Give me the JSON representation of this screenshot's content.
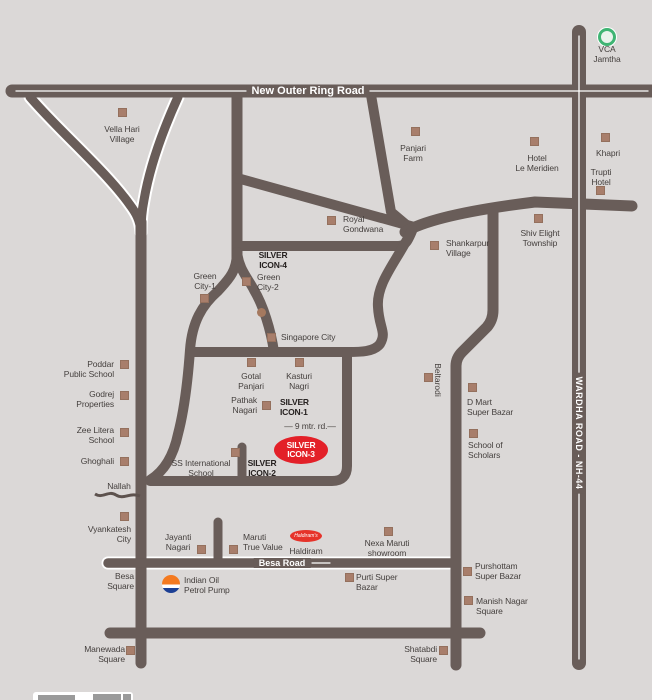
{
  "map": {
    "title_region": "site location map",
    "colors": {
      "background": "#dbd8d7",
      "road": "#695d59",
      "road_line_white": "#ffffff",
      "marker": "#a87e6b",
      "badge_red": "#e32028",
      "vca_green": "#3fb473",
      "haldiram_red": "#e6332a",
      "indianoil_orange": "#f47a20",
      "indianoil_blue": "#1c3f94",
      "label_text": "#443f3d"
    },
    "road_labels": [
      {
        "type": "roadlabel",
        "id": "new-outer-ring-road",
        "text": "New Outer Ring Road",
        "x": 308,
        "y": 91,
        "size": 11
      },
      {
        "type": "roadlabel",
        "id": "besa-road",
        "text": "Besa Road",
        "x": 282,
        "y": 563,
        "size": 9
      },
      {
        "type": "vroadlabel",
        "id": "wardha-road-nh-44",
        "text": "WARDHA ROAD - NH-44",
        "x": 579,
        "y": 433,
        "size": 9
      }
    ],
    "places": [
      {
        "type": "vca-icon",
        "id": "vca-jamtha-icon",
        "x": 607,
        "y": 37
      },
      {
        "id": "vca-jamtha",
        "lines": [
          "VCA",
          "Jamtha"
        ],
        "align": "center",
        "x": 607,
        "y": 44
      },
      {
        "id": "vella-hari-village",
        "lines": [
          "Vella Hari",
          "Village"
        ],
        "align": "center",
        "x": 122,
        "y": 124,
        "marker": {
          "x": 122,
          "y": 112
        }
      },
      {
        "id": "panjari-farm",
        "lines": [
          "Panjari",
          "Farm"
        ],
        "align": "center",
        "x": 413,
        "y": 143,
        "marker": {
          "x": 415,
          "y": 131
        }
      },
      {
        "id": "hotel-le-meridien",
        "lines": [
          "Hotel",
          "Le Meridien"
        ],
        "align": "center",
        "x": 537,
        "y": 153,
        "marker": {
          "x": 534,
          "y": 141
        }
      },
      {
        "id": "khapri",
        "lines": [
          "Khapri"
        ],
        "align": "center",
        "x": 608,
        "y": 148,
        "marker": {
          "x": 605,
          "y": 137
        }
      },
      {
        "id": "trupti-hotel",
        "lines": [
          "Trupti",
          "Hotel"
        ],
        "align": "center",
        "x": 601,
        "y": 167,
        "marker": {
          "x": 600,
          "y": 190
        }
      },
      {
        "id": "royal-gondwana",
        "lines": [
          "Royal",
          "Gondwana"
        ],
        "align": "left",
        "x": 343,
        "y": 214,
        "marker": {
          "x": 331,
          "y": 220
        }
      },
      {
        "id": "shankarpur-village",
        "lines": [
          "Shankarpur",
          "Village"
        ],
        "align": "left",
        "x": 446,
        "y": 238,
        "marker": {
          "x": 434,
          "y": 245
        }
      },
      {
        "id": "shiv-elight-township",
        "lines": [
          "Shiv Elight",
          "Township"
        ],
        "align": "center",
        "x": 540,
        "y": 228,
        "marker": {
          "x": 538,
          "y": 218
        }
      },
      {
        "id": "silver-icon-4",
        "lines": [
          "SILVER",
          "ICON-4"
        ],
        "align": "center",
        "x": 273,
        "y": 250,
        "bold": true
      },
      {
        "id": "green-city-1",
        "lines": [
          "Green",
          "City-1"
        ],
        "align": "center",
        "x": 205,
        "y": 271,
        "marker": {
          "x": 204,
          "y": 298
        }
      },
      {
        "id": "green-city-2",
        "lines": [
          "Green",
          "City-2"
        ],
        "align": "left",
        "x": 257,
        "y": 272,
        "marker": {
          "x": 246,
          "y": 281
        }
      },
      {
        "type": "dot",
        "id": "green-city-dot",
        "x": 261,
        "y": 312
      },
      {
        "id": "singapore-city",
        "lines": [
          "Singapore City"
        ],
        "align": "left",
        "x": 281,
        "y": 332,
        "marker": {
          "x": 271,
          "y": 337
        }
      },
      {
        "id": "poddar-public-school",
        "lines": [
          "Poddar",
          "Public School"
        ],
        "align": "right",
        "x": 114,
        "y": 359,
        "marker": {
          "x": 124,
          "y": 364
        }
      },
      {
        "id": "godrej-properties",
        "lines": [
          "Godrej",
          "Properties"
        ],
        "align": "right",
        "x": 114,
        "y": 389,
        "marker": {
          "x": 124,
          "y": 395
        }
      },
      {
        "id": "zee-litera-school",
        "lines": [
          "Zee Litera",
          "School"
        ],
        "align": "right",
        "x": 114,
        "y": 425,
        "marker": {
          "x": 124,
          "y": 432
        }
      },
      {
        "id": "ghoghali",
        "lines": [
          "Ghoghali"
        ],
        "align": "right",
        "x": 114,
        "y": 456,
        "marker": {
          "x": 124,
          "y": 461
        }
      },
      {
        "id": "gotal-panjari",
        "lines": [
          "Gotal",
          "Panjari"
        ],
        "align": "center",
        "x": 251,
        "y": 371,
        "marker": {
          "x": 251,
          "y": 362
        }
      },
      {
        "id": "kasturi-nagri",
        "lines": [
          "Kasturi",
          "Nagri"
        ],
        "align": "center",
        "x": 299,
        "y": 371,
        "marker": {
          "x": 299,
          "y": 362
        }
      },
      {
        "id": "pathak-nagari",
        "lines": [
          "Pathak",
          "Nagari"
        ],
        "align": "right",
        "x": 257,
        "y": 395,
        "marker": {
          "x": 266,
          "y": 405
        }
      },
      {
        "id": "silver-icon-1",
        "lines": [
          "SILVER",
          "ICON-1"
        ],
        "align": "left",
        "x": 280,
        "y": 397,
        "bold": true
      },
      {
        "id": "nine-mtr-rd",
        "lines": [
          "— 9 mtr. rd.—"
        ],
        "align": "center",
        "x": 310,
        "y": 421
      },
      {
        "type": "badge",
        "id": "silver-icon-3",
        "lines": [
          "SILVER",
          "ICON-3"
        ],
        "x": 301,
        "y": 450
      },
      {
        "id": "ss-international-school",
        "lines": [
          "SS International",
          "School"
        ],
        "align": "center",
        "x": 201,
        "y": 458,
        "marker": {
          "x": 235,
          "y": 452
        }
      },
      {
        "id": "silver-icon-2",
        "lines": [
          "SILVER",
          "ICON-2"
        ],
        "align": "center",
        "x": 262,
        "y": 458,
        "bold": true
      },
      {
        "type": "vlabel",
        "id": "beltarodi",
        "text": "Beltarodi",
        "x": 438,
        "y": 380,
        "marker": {
          "x": 428,
          "y": 377
        }
      },
      {
        "id": "d-mart-super-bazar",
        "lines": [
          "D Mart",
          "Super Bazar"
        ],
        "align": "left",
        "x": 467,
        "y": 397,
        "marker": {
          "x": 472,
          "y": 387
        }
      },
      {
        "id": "school-of-scholars",
        "lines": [
          "School of",
          "Scholars"
        ],
        "align": "left",
        "x": 468,
        "y": 440,
        "marker": {
          "x": 473,
          "y": 433
        }
      },
      {
        "id": "nallah",
        "lines": [
          "Nallah"
        ],
        "align": "center",
        "x": 119,
        "y": 481
      },
      {
        "id": "vyankatesh-city",
        "lines": [
          "Vyankatesh",
          "City"
        ],
        "align": "right",
        "x": 131,
        "y": 524,
        "marker": {
          "x": 124,
          "y": 516
        }
      },
      {
        "id": "jayanti-nagari",
        "lines": [
          "Jayanti",
          "Nagari"
        ],
        "align": "center",
        "x": 178,
        "y": 532,
        "marker": {
          "x": 201,
          "y": 549
        }
      },
      {
        "id": "maruti-true-value",
        "lines": [
          "Maruti",
          "True Value"
        ],
        "align": "left",
        "x": 243,
        "y": 532,
        "marker": {
          "x": 233,
          "y": 549
        }
      },
      {
        "type": "haldiram-logo",
        "id": "haldiram-logo",
        "x": 306,
        "y": 536,
        "text": "Haldiram's"
      },
      {
        "id": "haldiram",
        "lines": [
          "Haldiram"
        ],
        "align": "center",
        "x": 306,
        "y": 546
      },
      {
        "id": "nexa-maruti-showroom",
        "lines": [
          "Nexa Maruti",
          "showroom"
        ],
        "align": "center",
        "x": 387,
        "y": 538,
        "marker": {
          "x": 388,
          "y": 531
        }
      },
      {
        "id": "besa-square",
        "lines": [
          "Besa",
          "Square"
        ],
        "align": "right",
        "x": 134,
        "y": 571
      },
      {
        "type": "indianoil-logo",
        "id": "indian-oil-logo",
        "x": 171,
        "y": 584
      },
      {
        "id": "indian-oil-petrol-pump",
        "lines": [
          "Indian Oil",
          "Petrol Pump"
        ],
        "align": "left",
        "x": 184,
        "y": 575
      },
      {
        "id": "purti-super-bazar",
        "lines": [
          "Purti Super",
          "Bazar"
        ],
        "align": "left",
        "x": 356,
        "y": 572,
        "marker": {
          "x": 349,
          "y": 577
        }
      },
      {
        "id": "purshottam-super-bazar",
        "lines": [
          "Purshottam",
          "Super Bazar"
        ],
        "align": "left",
        "x": 475,
        "y": 561,
        "marker": {
          "x": 467,
          "y": 571
        }
      },
      {
        "id": "manish-nagar-square",
        "lines": [
          "Manish Nagar",
          "Square"
        ],
        "align": "left",
        "x": 476,
        "y": 596,
        "marker": {
          "x": 468,
          "y": 600
        }
      },
      {
        "id": "manewada-square",
        "lines": [
          "Manewada",
          "Square"
        ],
        "align": "right",
        "x": 125,
        "y": 644,
        "marker": {
          "x": 130,
          "y": 650
        }
      },
      {
        "id": "shatabdi-square",
        "lines": [
          "Shatabdi",
          "Square"
        ],
        "align": "right",
        "x": 437,
        "y": 644,
        "marker": {
          "x": 443,
          "y": 650
        }
      }
    ]
  }
}
